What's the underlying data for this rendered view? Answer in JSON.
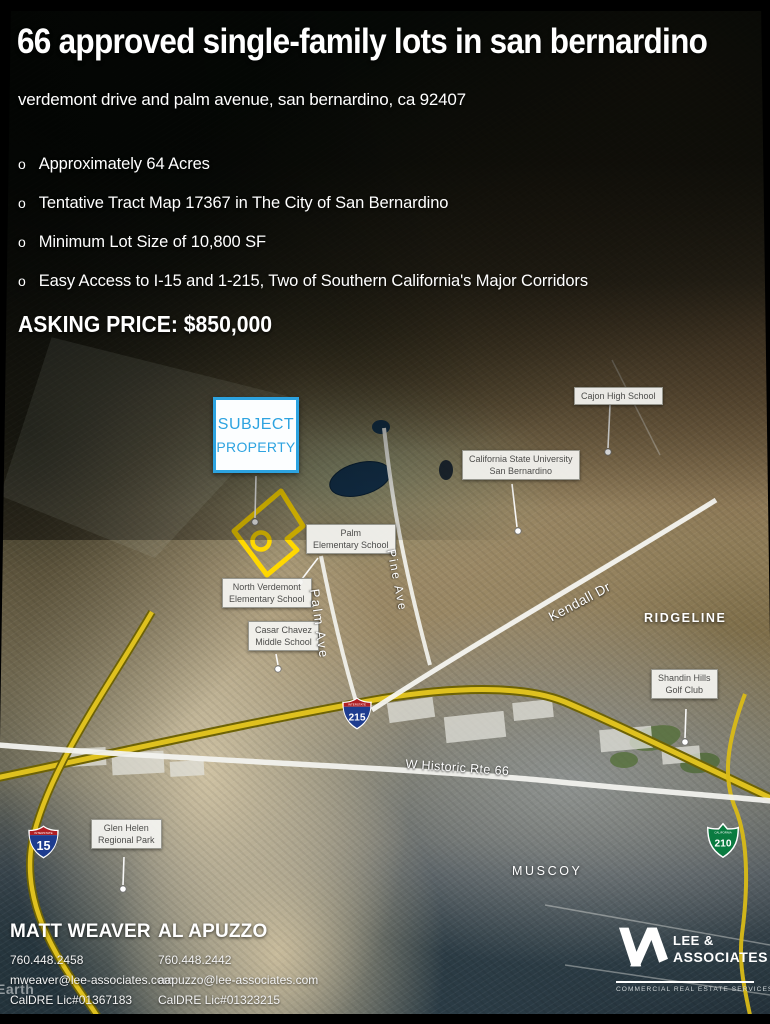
{
  "header": {
    "title": "66 approved single-family lots in san bernardino",
    "subtitle": "verdemont drive and palm avenue, san bernardino, ca 92407",
    "bullet_marker": "o",
    "bullets": [
      "Approximately 64 Acres",
      "Tentative Tract Map 17367 in The City of San Bernardino",
      "Minimum Lot Size of 10,800 SF",
      "Easy Access to I-15 and 1-215, Two of Southern California's Major Corridors"
    ],
    "asking_price": "ASKING PRICE: $850,000"
  },
  "map": {
    "callout": {
      "line1": "SUBJECT",
      "line2": "PROPERTY",
      "accent_color": "#2da3e0"
    },
    "property_outline_color": "#ffd800",
    "labels": [
      {
        "id": "cajon-high-school",
        "lines": [
          "Cajon High School"
        ]
      },
      {
        "id": "csu-san-bernardino",
        "lines": [
          "California State University",
          "San Bernardino"
        ]
      },
      {
        "id": "palm-elementary",
        "lines": [
          "Palm",
          "Elementary School"
        ]
      },
      {
        "id": "north-verdemont",
        "lines": [
          "North Verdemont",
          "Elementary School"
        ]
      },
      {
        "id": "casar-chavez",
        "lines": [
          "Casar Chavez",
          "Middle School"
        ]
      },
      {
        "id": "glen-helen",
        "lines": [
          "Glen Helen",
          "Regional Park"
        ]
      },
      {
        "id": "shandin-hills",
        "lines": [
          "Shandin Hills",
          "Golf Club"
        ]
      }
    ],
    "area_labels": {
      "ridgeline": "RIDGELINE",
      "muscoy": "MUSCOY"
    },
    "road_labels": {
      "palm_ave": "Palm Ave",
      "pine_ave": "Pine Ave",
      "kendall_dr": "Kendall Dr",
      "rte66": "W Historic Rte 66"
    },
    "shields": {
      "i215": {
        "caption": "INTERSTATE",
        "number": "215"
      },
      "i15": {
        "caption": "INTERSTATE",
        "number": "15"
      },
      "ca210": {
        "caption": "CALIFORNIA",
        "number": "210"
      }
    },
    "watermark": "Earth"
  },
  "contacts": [
    {
      "name": "MATT WEAVER",
      "phone": "760.448.2458",
      "email": "mweaver@lee-associates.com",
      "license": "CalDRE Lic#01367183"
    },
    {
      "name": "AL APUZZO",
      "phone": "760.448.2442",
      "email": "aapuzzo@lee-associates.com",
      "license": "CalDRE Lic#01323215"
    }
  ],
  "logo": {
    "name_line1": "LEE &",
    "name_line2": "ASSOCIATES",
    "tagline": "COMMERCIAL REAL ESTATE SERVICES"
  }
}
